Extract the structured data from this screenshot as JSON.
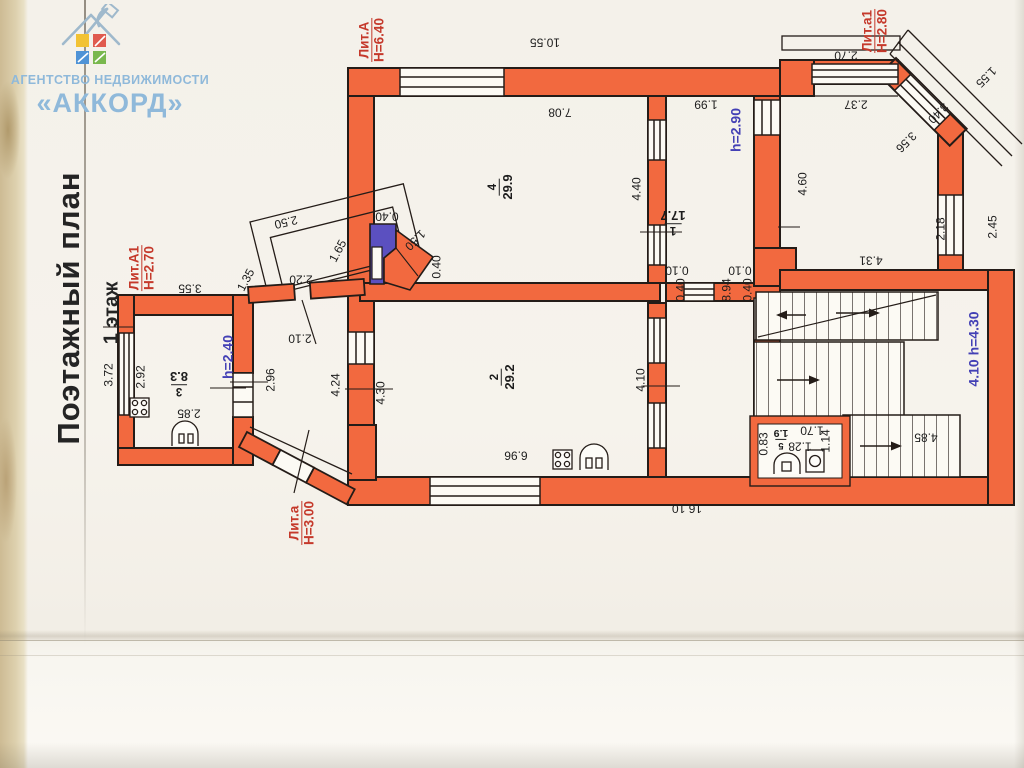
{
  "logo": {
    "line1": "АГЕНТСТВО НЕДВИЖИМОСТИ",
    "line2": "«АККОРД»"
  },
  "titles": {
    "plan": "Поэтажный план",
    "floor": "1 этаж"
  },
  "colors": {
    "wall_orange": "#f2693f",
    "label_red": "#c5392b",
    "label_blue": "#4340b5",
    "logo_blue": "#8fb9da",
    "stove_purple": "#5b50c0"
  },
  "lit_labels": [
    {
      "name": "Лит.А",
      "height": "Н=6.40",
      "x": 372,
      "y": 40,
      "rot": -90
    },
    {
      "name": "Лит.а1",
      "height": "Н=2.80",
      "x": 875,
      "y": 31,
      "rot": -90
    },
    {
      "name": "Лит.А1",
      "height": "Н=2.70",
      "x": 142,
      "y": 268,
      "rot": -90
    },
    {
      "name": "Лит.а",
      "height": "Н=3.00",
      "x": 302,
      "y": 523,
      "rot": -90
    }
  ],
  "height_labels": [
    {
      "text": "h=2.90",
      "x": 736,
      "y": 130,
      "rot": -90
    },
    {
      "text": "h=2.40",
      "x": 228,
      "y": 357,
      "rot": -90
    },
    {
      "text": "4.10 h=4.30",
      "x": 974,
      "y": 349,
      "rot": -90
    }
  ],
  "room_labels": [
    {
      "number": "1",
      "area": "17.7",
      "x": 673,
      "y": 224,
      "rot": 180,
      "small": false
    },
    {
      "number": "2",
      "area": "29.2",
      "x": 501,
      "y": 377,
      "rot": -90,
      "small": false
    },
    {
      "number": "3",
      "area": "8.3",
      "x": 179,
      "y": 385,
      "rot": 180,
      "small": false
    },
    {
      "number": "4",
      "area": "29.9",
      "x": 499,
      "y": 187,
      "rot": -90,
      "small": false
    },
    {
      "number": "5",
      "area": "1.9",
      "x": 781,
      "y": 441,
      "rot": 180,
      "small": true
    }
  ],
  "dim_labels": [
    {
      "text": "10.55",
      "x": 545,
      "y": 42,
      "rot": 180
    },
    {
      "text": "7.08",
      "x": 560,
      "y": 112,
      "rot": 180
    },
    {
      "text": "1.99",
      "x": 706,
      "y": 104,
      "rot": 180
    },
    {
      "text": "2.70",
      "x": 846,
      "y": 55,
      "rot": 180
    },
    {
      "text": "2.37",
      "x": 856,
      "y": 104,
      "rot": 180
    },
    {
      "text": "3.55",
      "x": 190,
      "y": 288,
      "rot": 180
    },
    {
      "text": "2.50",
      "x": 286,
      "y": 222,
      "rot": 167
    },
    {
      "text": "2.20",
      "x": 301,
      "y": 279,
      "rot": 180
    },
    {
      "text": "2.10",
      "x": 300,
      "y": 338,
      "rot": 180
    },
    {
      "text": "2.85",
      "x": 189,
      "y": 413,
      "rot": 180
    },
    {
      "text": "6.96",
      "x": 516,
      "y": 455,
      "rot": 180
    },
    {
      "text": "16.10",
      "x": 687,
      "y": 508,
      "rot": 180
    },
    {
      "text": "4.31",
      "x": 871,
      "y": 260,
      "rot": 180
    },
    {
      "text": "4.85",
      "x": 926,
      "y": 437,
      "rot": 180
    },
    {
      "text": "1.70",
      "x": 812,
      "y": 430,
      "rot": 180
    },
    {
      "text": "1.28",
      "x": 800,
      "y": 446,
      "rot": 180
    },
    {
      "text": "1.14",
      "x": 826,
      "y": 441,
      "rot": -90
    },
    {
      "text": "0.83",
      "x": 764,
      "y": 444,
      "rot": -90
    },
    {
      "text": "0.40",
      "x": 387,
      "y": 216,
      "rot": 180
    },
    {
      "text": "1.50",
      "x": 415,
      "y": 240,
      "rot": 135
    },
    {
      "text": "0.40",
      "x": 437,
      "y": 267,
      "rot": -90
    },
    {
      "text": "0.10",
      "x": 677,
      "y": 270,
      "rot": 180
    },
    {
      "text": "0.40",
      "x": 681,
      "y": 290,
      "rot": -90
    },
    {
      "text": "0.10",
      "x": 740,
      "y": 270,
      "rot": 180
    },
    {
      "text": "0.40",
      "x": 748,
      "y": 290,
      "rot": -90
    },
    {
      "text": "8.94",
      "x": 727,
      "y": 290,
      "rot": -90
    },
    {
      "text": "3.72",
      "x": 109,
      "y": 375,
      "rot": -90
    },
    {
      "text": "2.92",
      "x": 141,
      "y": 377,
      "rot": -90
    },
    {
      "text": "2.96",
      "x": 271,
      "y": 380,
      "rot": -90
    },
    {
      "text": "4.24",
      "x": 336,
      "y": 385,
      "rot": -90
    },
    {
      "text": "4.30",
      "x": 381,
      "y": 393,
      "rot": -90
    },
    {
      "text": "4.40",
      "x": 637,
      "y": 189,
      "rot": -90
    },
    {
      "text": "4.10",
      "x": 641,
      "y": 380,
      "rot": -90
    },
    {
      "text": "4.60",
      "x": 803,
      "y": 184,
      "rot": -90
    },
    {
      "text": "2.18",
      "x": 941,
      "y": 229,
      "rot": -90
    },
    {
      "text": "2.45",
      "x": 993,
      "y": 227,
      "rot": -90
    },
    {
      "text": "1.65",
      "x": 338,
      "y": 251,
      "rot": -62
    },
    {
      "text": "1.35",
      "x": 246,
      "y": 280,
      "rot": -62
    },
    {
      "text": "1.55",
      "x": 986,
      "y": 77,
      "rot": 135
    },
    {
      "text": "3.40",
      "x": 938,
      "y": 113,
      "rot": 135
    },
    {
      "text": "3.56",
      "x": 906,
      "y": 142,
      "rot": 135
    }
  ]
}
